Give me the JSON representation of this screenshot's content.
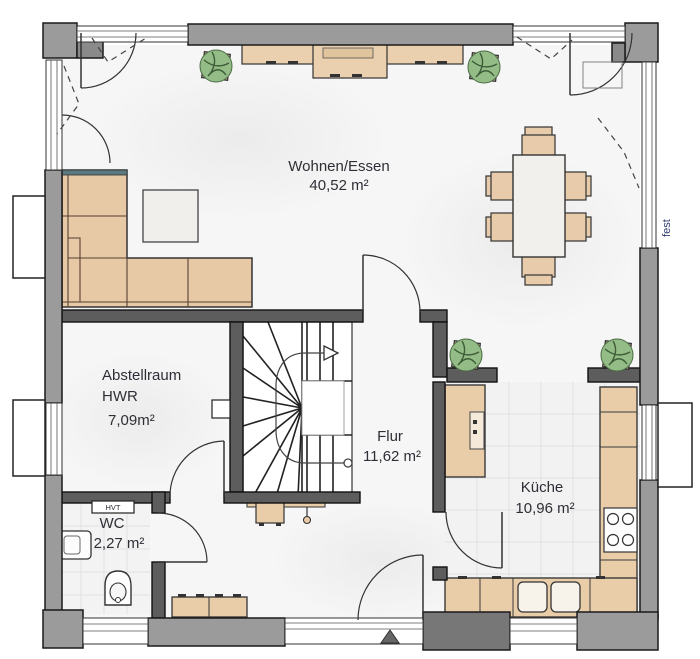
{
  "rooms": {
    "living": {
      "name": "Wohnen/Essen",
      "area": "40,52 m²"
    },
    "storage": {
      "name": "Abstellraum",
      "name2": "HWR",
      "area": "7,09m²"
    },
    "hall": {
      "name": "Flur",
      "area": "11,62 m²"
    },
    "kitchen": {
      "name": "Küche",
      "area": "10,96 m²"
    },
    "wc": {
      "name": "WC",
      "area": "2,27 m²"
    }
  },
  "annotations": {
    "fixed_window": "fest",
    "utility_panel": "HVT"
  },
  "colors": {
    "exterior_wall": "#9b9b9b",
    "interior_wall": "#5d5d5d",
    "furniture_wood": "#e9cda9",
    "plant_green": "#94bc86",
    "floor": "#f6f6f6",
    "tile": "#f2f2f2",
    "label_text": "#2e2e36",
    "fest_text": "#2b3a6b"
  }
}
